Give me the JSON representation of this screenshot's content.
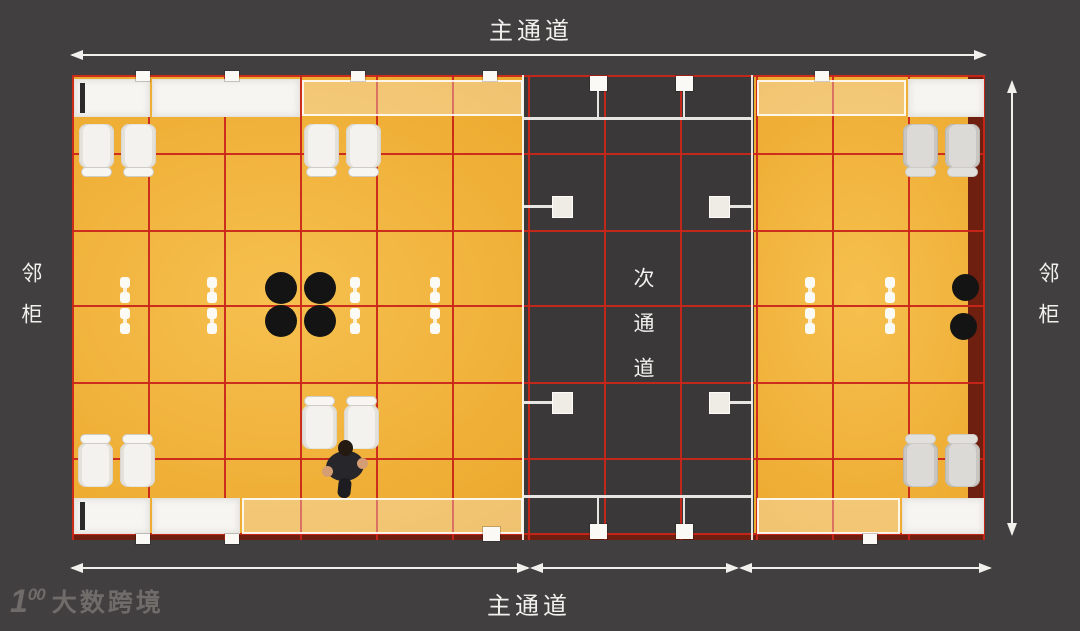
{
  "labels": {
    "top_aisle": "主通道",
    "bottom_aisle": "主通道",
    "left_neighbor": "邻柜",
    "right_neighbor": "邻柜",
    "secondary_aisle": "次通道"
  },
  "watermark": {
    "logo_prefix": "1",
    "logo_suffix": "00",
    "text": "大数跨境"
  },
  "colors": {
    "background": "#413f40",
    "booth_floor_yellow": "#eeac32",
    "aisle_floor_dark": "#3a3839",
    "grid_red": "#c9261a",
    "edge_maroon": "#6e1f10",
    "structure_white": "#f7f5f1",
    "dimension_line": "#f2f0ed",
    "watermark_gray": "#6f6c6a",
    "stool_black": "#141414"
  },
  "plan": {
    "width": 913,
    "height": 465,
    "zones": [
      {
        "n": "left-booth",
        "kind": "booth",
        "x": 0,
        "w": 452
      },
      {
        "n": "secondary-aisle",
        "kind": "aisle",
        "x": 452,
        "w": 230
      },
      {
        "n": "right-booth",
        "kind": "booth",
        "x": 682,
        "w": 231
      },
      {
        "n": "right-edge-strip",
        "kind": "maroon",
        "x": 896,
        "w": 17
      },
      {
        "n": "bottom-edge-strip",
        "kind": "maroon",
        "x": 0,
        "y": 459,
        "w": 913,
        "h": 6
      }
    ],
    "grid": {
      "thickness": 2,
      "vertical_x": [
        0,
        76,
        152,
        228,
        304,
        380,
        456,
        532,
        608,
        684,
        760,
        836,
        911
      ],
      "horizontal_y": [
        0,
        78,
        155,
        230,
        307,
        383,
        458
      ]
    },
    "shapes": [
      {
        "t": "band",
        "n": "top-left-cabinet",
        "x": 2,
        "y": 4,
        "w": 76,
        "h": 38
      },
      {
        "t": "darkbar",
        "n": "top-left-cabinet-slot",
        "x": 8,
        "y": 8,
        "w": 5,
        "h": 30
      },
      {
        "t": "band",
        "n": "top-left-counter",
        "x": 80,
        "y": 4,
        "w": 148,
        "h": 38
      },
      {
        "t": "bandlite",
        "n": "top-left-shelf",
        "x": 230,
        "y": 5,
        "w": 221,
        "h": 36
      },
      {
        "t": "bandlite",
        "n": "top-right-shelf",
        "x": 685,
        "y": 5,
        "w": 149,
        "h": 36
      },
      {
        "t": "band",
        "n": "top-right-cabinet",
        "x": 836,
        "y": 4,
        "w": 76,
        "h": 38
      },
      {
        "t": "band",
        "n": "bottom-left-cabinet",
        "x": 2,
        "y": 423,
        "w": 76,
        "h": 36
      },
      {
        "t": "darkbar",
        "n": "bottom-left-cabinet-slot",
        "x": 8,
        "y": 427,
        "w": 5,
        "h": 28
      },
      {
        "t": "band",
        "n": "bottom-left-counter",
        "x": 80,
        "y": 423,
        "w": 88,
        "h": 36
      },
      {
        "t": "bandlite",
        "n": "bottom-left-shelf",
        "x": 170,
        "y": 423,
        "w": 281,
        "h": 36
      },
      {
        "t": "bandlite",
        "n": "bottom-right-shelf",
        "x": 685,
        "y": 423,
        "w": 143,
        "h": 36
      },
      {
        "t": "band",
        "n": "bottom-right-cabinet",
        "x": 830,
        "y": 423,
        "w": 82,
        "h": 36
      },
      {
        "t": "wline",
        "n": "aisle-left-wall",
        "x": 450,
        "y": 0,
        "w": 2,
        "h": 465
      },
      {
        "t": "wline",
        "n": "aisle-right-wall",
        "x": 679,
        "y": 0,
        "w": 2,
        "h": 465
      },
      {
        "t": "wline",
        "n": "aisle-top-beam",
        "x": 452,
        "y": 42,
        "w": 228,
        "h": 3
      },
      {
        "t": "wline",
        "n": "aisle-bottom-beam",
        "x": 452,
        "y": 420,
        "w": 228,
        "h": 3
      },
      {
        "t": "post",
        "n": "aisle-post-top-left",
        "x": 518,
        "y": 1,
        "w": 17,
        "h": 15
      },
      {
        "t": "post",
        "n": "aisle-post-top-right",
        "x": 604,
        "y": 1,
        "w": 17,
        "h": 15
      },
      {
        "t": "wline",
        "n": "aisle-post-stem",
        "x": 525,
        "y": 16,
        "w": 2,
        "h": 26
      },
      {
        "t": "wline",
        "n": "aisle-post-stem",
        "x": 611,
        "y": 16,
        "w": 2,
        "h": 26
      },
      {
        "t": "post",
        "n": "aisle-post-bottom-left",
        "x": 518,
        "y": 449,
        "w": 17,
        "h": 15
      },
      {
        "t": "post",
        "n": "aisle-post-bottom-right",
        "x": 604,
        "y": 449,
        "w": 17,
        "h": 15
      },
      {
        "t": "wline",
        "n": "aisle-post-stem",
        "x": 525,
        "y": 423,
        "w": 2,
        "h": 26
      },
      {
        "t": "wline",
        "n": "aisle-post-stem",
        "x": 611,
        "y": 423,
        "w": 2,
        "h": 26
      },
      {
        "t": "sq",
        "n": "aisle-fixture",
        "x": 480,
        "y": 121,
        "w": 21,
        "h": 22
      },
      {
        "t": "wline",
        "n": "aisle-fixture-arm",
        "x": 452,
        "y": 130,
        "w": 28,
        "h": 3
      },
      {
        "t": "sq",
        "n": "aisle-fixture",
        "x": 637,
        "y": 121,
        "w": 21,
        "h": 22
      },
      {
        "t": "wline",
        "n": "aisle-fixture-arm",
        "x": 658,
        "y": 130,
        "w": 22,
        "h": 3
      },
      {
        "t": "sq",
        "n": "aisle-fixture",
        "x": 480,
        "y": 317,
        "w": 21,
        "h": 22
      },
      {
        "t": "wline",
        "n": "aisle-fixture-arm",
        "x": 452,
        "y": 326,
        "w": 28,
        "h": 3
      },
      {
        "t": "sq",
        "n": "aisle-fixture",
        "x": 637,
        "y": 317,
        "w": 21,
        "h": 22
      },
      {
        "t": "wline",
        "n": "aisle-fixture-arm",
        "x": 658,
        "y": 326,
        "w": 22,
        "h": 3
      },
      {
        "t": "post",
        "n": "wall-post",
        "x": 64,
        "y": -4,
        "w": 14,
        "h": 10
      },
      {
        "t": "post",
        "n": "wall-post",
        "x": 153,
        "y": -4,
        "w": 14,
        "h": 10
      },
      {
        "t": "post",
        "n": "wall-post",
        "x": 279,
        "y": -4,
        "w": 14,
        "h": 10
      },
      {
        "t": "post",
        "n": "wall-post",
        "x": 411,
        "y": -4,
        "w": 14,
        "h": 10
      },
      {
        "t": "post",
        "n": "wall-post",
        "x": 743,
        "y": -4,
        "w": 14,
        "h": 10
      },
      {
        "t": "post",
        "n": "wall-post",
        "x": 64,
        "y": 459,
        "w": 14,
        "h": 10
      },
      {
        "t": "post",
        "n": "wall-post",
        "x": 153,
        "y": 459,
        "w": 14,
        "h": 10
      },
      {
        "t": "post",
        "n": "wall-post",
        "x": 411,
        "y": 452,
        "w": 17,
        "h": 14
      },
      {
        "t": "post",
        "n": "wall-post",
        "x": 791,
        "y": 459,
        "w": 14,
        "h": 10
      },
      {
        "t": "chair",
        "n": "chair",
        "x": 7,
        "y": 49,
        "w": 35,
        "h": 44,
        "back": "bottom"
      },
      {
        "t": "chair",
        "n": "chair",
        "x": 49,
        "y": 49,
        "w": 35,
        "h": 44,
        "back": "bottom"
      },
      {
        "t": "chair",
        "n": "chair",
        "x": 232,
        "y": 49,
        "w": 35,
        "h": 44,
        "back": "bottom"
      },
      {
        "t": "chair",
        "n": "chair",
        "x": 274,
        "y": 49,
        "w": 35,
        "h": 44,
        "back": "bottom"
      },
      {
        "t": "chair",
        "n": "chair",
        "x": 6,
        "y": 368,
        "w": 35,
        "h": 44,
        "back": "top"
      },
      {
        "t": "chair",
        "n": "chair",
        "x": 48,
        "y": 368,
        "w": 35,
        "h": 44,
        "back": "top"
      },
      {
        "t": "chair",
        "n": "chair",
        "x": 230,
        "y": 330,
        "w": 35,
        "h": 44,
        "back": "top"
      },
      {
        "t": "chair",
        "n": "chair",
        "x": 272,
        "y": 330,
        "w": 35,
        "h": 44,
        "back": "top"
      },
      {
        "t": "chair",
        "n": "chair",
        "x": 831,
        "y": 49,
        "w": 35,
        "h": 44,
        "back": "bottom",
        "gray": true
      },
      {
        "t": "chair",
        "n": "chair",
        "x": 873,
        "y": 49,
        "w": 35,
        "h": 44,
        "back": "bottom",
        "gray": true
      },
      {
        "t": "chair",
        "n": "chair",
        "x": 831,
        "y": 368,
        "w": 35,
        "h": 44,
        "back": "top",
        "gray": true
      },
      {
        "t": "chair",
        "n": "chair",
        "x": 873,
        "y": 368,
        "w": 35,
        "h": 44,
        "back": "top",
        "gray": true
      },
      {
        "t": "dot",
        "n": "black-stool",
        "x": 193,
        "y": 197,
        "w": 32,
        "h": 32
      },
      {
        "t": "dot",
        "n": "black-stool",
        "x": 232,
        "y": 197,
        "w": 32,
        "h": 32
      },
      {
        "t": "dot",
        "n": "black-stool",
        "x": 193,
        "y": 230,
        "w": 32,
        "h": 32
      },
      {
        "t": "dot",
        "n": "black-stool",
        "x": 232,
        "y": 230,
        "w": 32,
        "h": 32
      },
      {
        "t": "dot",
        "n": "black-stool",
        "x": 880,
        "y": 199,
        "w": 27,
        "h": 27
      },
      {
        "t": "dot",
        "n": "black-stool",
        "x": 878,
        "y": 238,
        "w": 27,
        "h": 27
      },
      {
        "t": "bottle",
        "n": "bottle",
        "x": 48,
        "y": 202,
        "w": 10,
        "h": 26
      },
      {
        "t": "bottle",
        "n": "bottle",
        "x": 48,
        "y": 233,
        "w": 10,
        "h": 26
      },
      {
        "t": "bottle",
        "n": "bottle",
        "x": 135,
        "y": 202,
        "w": 10,
        "h": 26
      },
      {
        "t": "bottle",
        "n": "bottle",
        "x": 135,
        "y": 233,
        "w": 10,
        "h": 26
      },
      {
        "t": "bottle",
        "n": "bottle",
        "x": 278,
        "y": 202,
        "w": 10,
        "h": 26
      },
      {
        "t": "bottle",
        "n": "bottle",
        "x": 278,
        "y": 233,
        "w": 10,
        "h": 26
      },
      {
        "t": "bottle",
        "n": "bottle",
        "x": 358,
        "y": 202,
        "w": 10,
        "h": 26
      },
      {
        "t": "bottle",
        "n": "bottle",
        "x": 358,
        "y": 233,
        "w": 10,
        "h": 26
      },
      {
        "t": "bottle",
        "n": "bottle",
        "x": 733,
        "y": 202,
        "w": 10,
        "h": 26
      },
      {
        "t": "bottle",
        "n": "bottle",
        "x": 733,
        "y": 233,
        "w": 10,
        "h": 26
      },
      {
        "t": "bottle",
        "n": "bottle",
        "x": 813,
        "y": 202,
        "w": 10,
        "h": 26
      },
      {
        "t": "bottle",
        "n": "bottle",
        "x": 813,
        "y": 233,
        "w": 10,
        "h": 26
      },
      {
        "t": "person",
        "n": "person",
        "x": 251,
        "y": 365,
        "w": 44,
        "h": 58
      }
    ]
  }
}
